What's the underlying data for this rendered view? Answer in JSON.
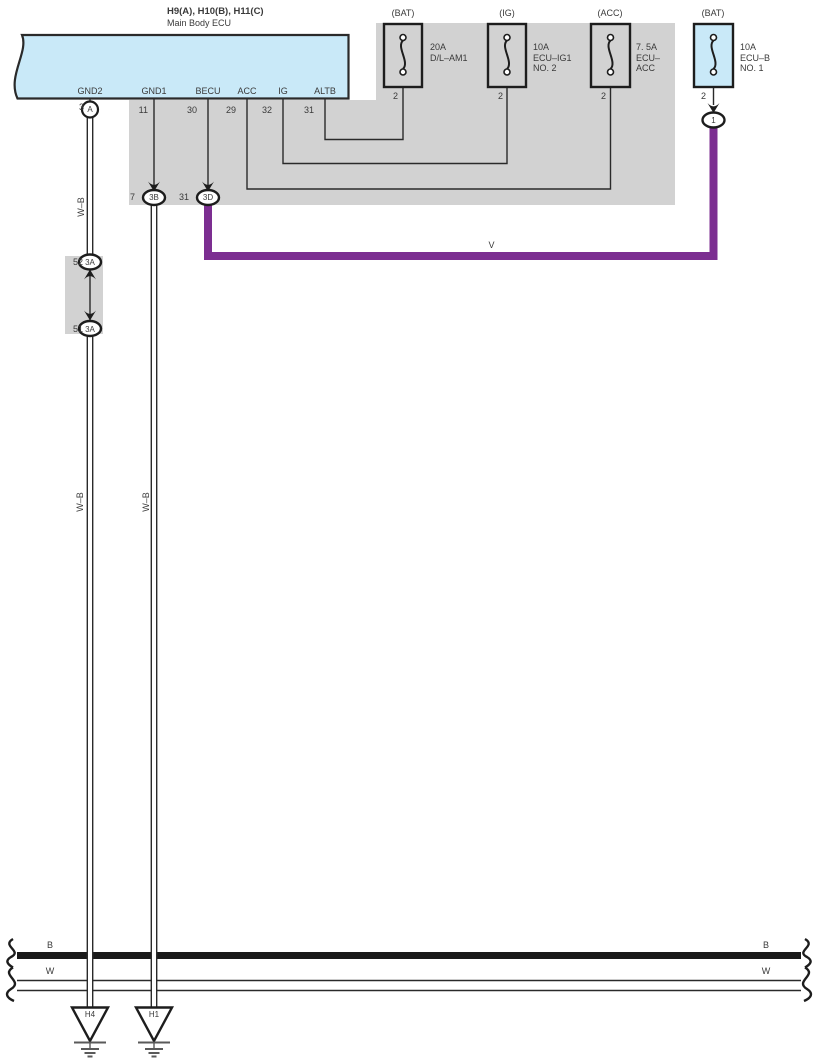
{
  "diagram": {
    "ecu": {
      "title": "H9(A), H10(B), H11(C)",
      "subtitle": "Main Body ECU",
      "pins": [
        {
          "label": "GND2",
          "number": "3"
        },
        {
          "label": "GND1",
          "number": "11"
        },
        {
          "label": "BECU",
          "number": "30"
        },
        {
          "label": "ACC",
          "number": "29"
        },
        {
          "label": "IG",
          "number": "32"
        },
        {
          "label": "ALTB",
          "number": "31"
        }
      ]
    },
    "fuses": [
      {
        "top_label": "(BAT)",
        "lines": [
          "20A",
          "D/L–AM1"
        ],
        "pin": "2"
      },
      {
        "top_label": "(IG)",
        "lines": [
          "10A",
          "ECU–IG1",
          "NO. 2"
        ],
        "pin": "2"
      },
      {
        "top_label": "(ACC)",
        "lines": [
          "7. 5A",
          "ECU–",
          "ACC"
        ],
        "pin": "2"
      },
      {
        "top_label": "(BAT)",
        "lines": [
          "10A",
          "ECU–B",
          "NO. 1"
        ],
        "pin": "2"
      }
    ],
    "connectors": {
      "ecu_gnd2_circle": "A",
      "fuse_ecu_b_circle": "1",
      "c3b": {
        "cavity": "7",
        "code": "3B"
      },
      "c3d": {
        "cavity": "31",
        "code": "3D"
      },
      "c3a_top": {
        "cavity": "52",
        "code": "3A"
      },
      "c3a_bottom": {
        "cavity": "51",
        "code": "3A"
      }
    },
    "wire_labels": {
      "wb": "W–B",
      "v": "V"
    },
    "bus": {
      "b": "B",
      "w": "W"
    },
    "grounds": {
      "h4": "H4",
      "h1": "H1"
    },
    "colors": {
      "ecu_fill": "#c9e9f8",
      "region_gray": "#d2d2d2",
      "purple": "#7c2e91",
      "line": "#2a2a2a"
    }
  }
}
